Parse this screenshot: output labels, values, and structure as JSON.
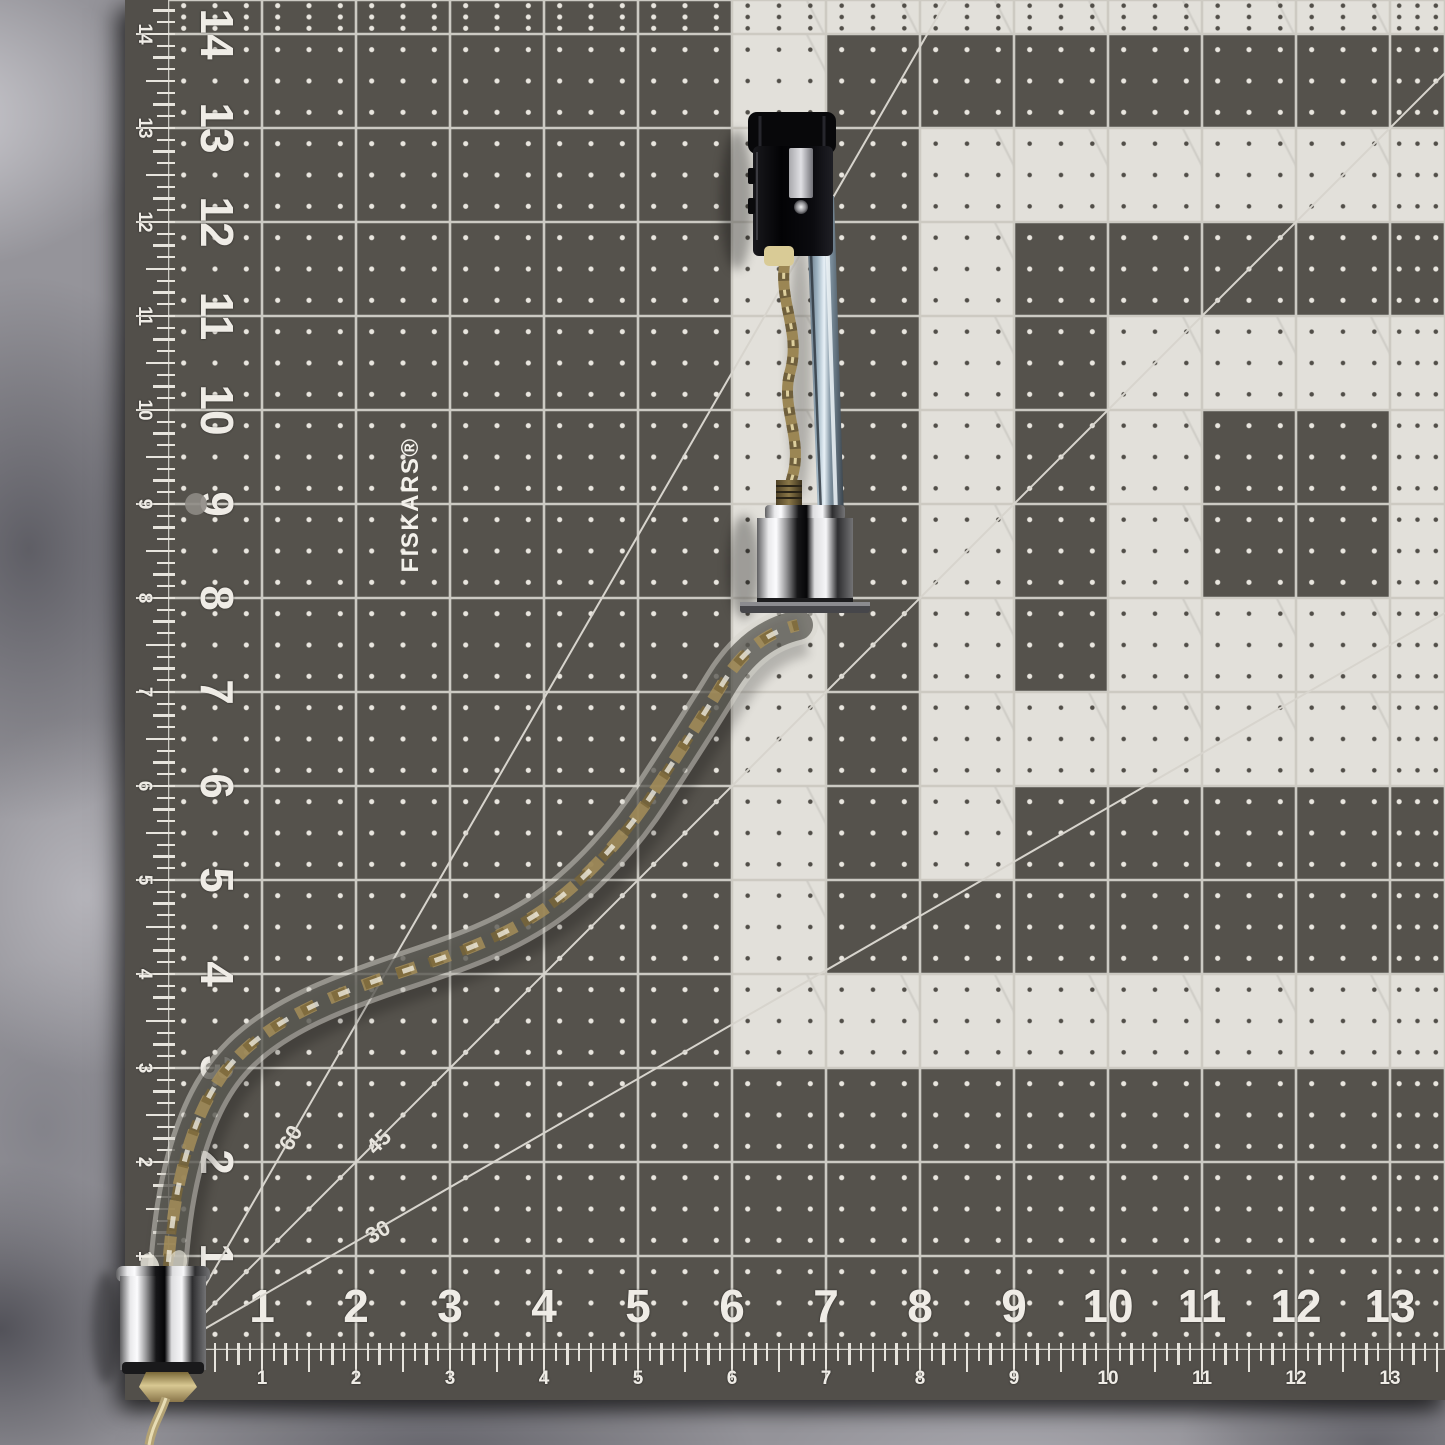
{
  "mat": {
    "brand": "FISKARS®",
    "pattern_rows": [
      "DDDDDDWWWWWWWW",
      "DDDDDDWDDDDDDD",
      "DDDDDDWDWWWWWW",
      "DDDDDDWDWDDDDD",
      "DDDDDDWDWDWWWW",
      "DDDDDDWDWDWDDW",
      "DDDDDDWDWDWDDW",
      "DDDDDDWDWDWWWW",
      "DDDDDDWDWWWWWW",
      "DDDDDDWDWDDDDD",
      "DDDDDDWDDDDDDD",
      "DDDDDDWWWWWWWW",
      "DDDDDDDDDDDDDD",
      "DDDDDDDDDDDDDD",
      "DDDDDDDDDDDDDD"
    ],
    "colors": {
      "dark_cell": "#55524c",
      "light_cell": "#e2e0da",
      "grid_line": "#e2dfd8",
      "ruler_text": "#efece6",
      "carpet": "#95949a"
    }
  },
  "rulers": {
    "left_numbers": [
      "14",
      "13",
      "12",
      "11",
      "10",
      "9",
      "8",
      "7",
      "6",
      "5",
      "4",
      "3",
      "2",
      "1"
    ],
    "bottom_numbers": [
      "1",
      "2",
      "3",
      "4",
      "5",
      "6",
      "7",
      "8",
      "9",
      "10",
      "11",
      "12",
      "13"
    ],
    "angle_labels": [
      {
        "text": "60"
      },
      {
        "text": "45"
      },
      {
        "text": "30"
      }
    ]
  },
  "object": {
    "parts": [
      "black-lamp-socket",
      "steel-strap",
      "twisted-brass-wire",
      "chrome-coupler",
      "twisted-glass-arm",
      "chrome-end-cap",
      "brass-hex-nut",
      "brass-wire-tail"
    ]
  }
}
